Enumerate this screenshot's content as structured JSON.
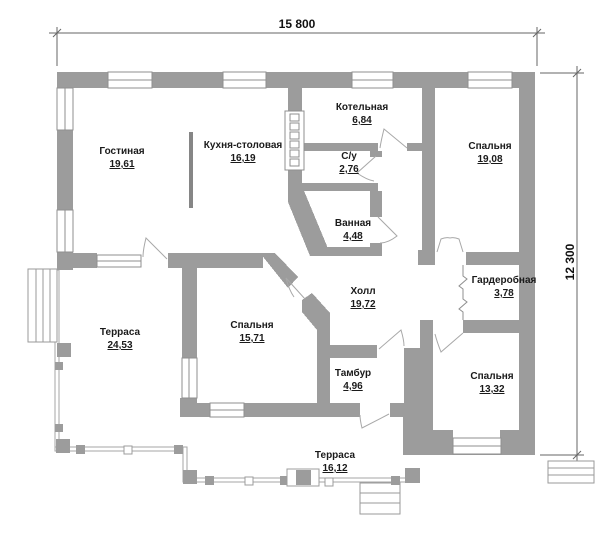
{
  "plan": {
    "type": "single-storey house floor plan",
    "wall_color": "#9c9c9c",
    "line_color": "#8f8f8f",
    "text_color": "#1a1a1a"
  },
  "dimensions": {
    "width_label": "15 800",
    "height_label": "12 300"
  },
  "rooms": [
    {
      "name": "Гостиная",
      "area": "19,61"
    },
    {
      "name": "Кухня-столовая",
      "area": "16,19"
    },
    {
      "name": "Котельная",
      "area": "6,84"
    },
    {
      "name": "С/у",
      "area": "2,76"
    },
    {
      "name": "Ванная",
      "area": "4,48"
    },
    {
      "name": "Спальня",
      "area": "19,08"
    },
    {
      "name": "Гардеробная",
      "area": "3,78"
    },
    {
      "name": "Холл",
      "area": "19,72"
    },
    {
      "name": "Терраса",
      "area": "24,53"
    },
    {
      "name": "Спальня",
      "area": "15,71"
    },
    {
      "name": "Тамбур",
      "area": "4,96"
    },
    {
      "name": "Спальня",
      "area": "13,32"
    },
    {
      "name": "Терраса",
      "area": "16,12"
    }
  ]
}
